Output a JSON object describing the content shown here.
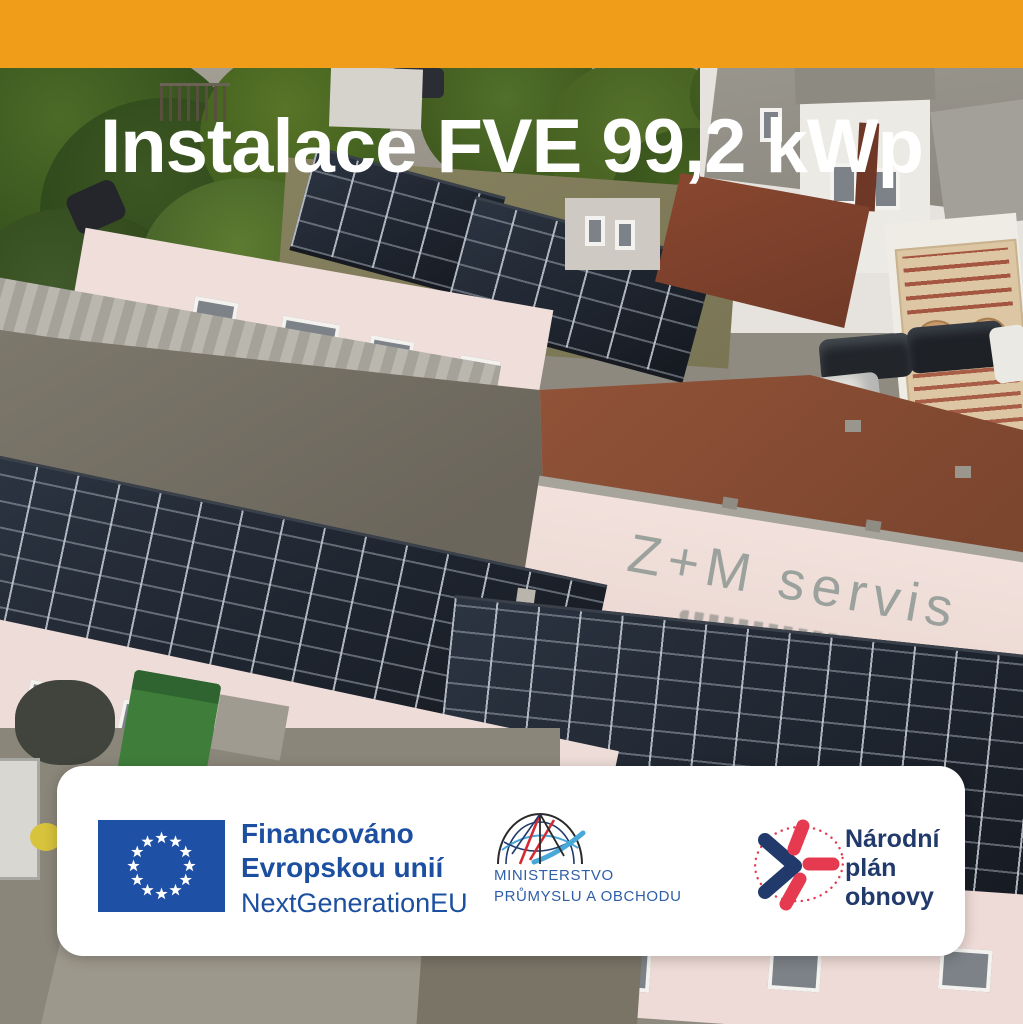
{
  "top_bar": {
    "color": "#F09D1A"
  },
  "headline": {
    "text": "Instalace FVE 99,2 kWp",
    "color": "#FFFFFF"
  },
  "photo": {
    "building_sign": {
      "text": "Z+M servis",
      "color": "#9BA19C"
    }
  },
  "footer_banner": {
    "background": "#FFFFFF",
    "eu_attribution": {
      "line1": "Financováno",
      "line2": "Evropskou unií",
      "line3": "NextGenerationEU",
      "flag_blue": "#1E50A5",
      "star_color": "#FFFFFF",
      "text_blue": "#1D4FA1"
    },
    "ministry": {
      "line1": "MINISTERSTVO",
      "line2": "PRŮMYSLU A OBCHODU",
      "text_blue": "#2E5FA7"
    },
    "npo": {
      "line1": "Národní",
      "line2": "plán",
      "line3": "obnovy",
      "navy": "#213A6B",
      "red": "#E53A4F"
    }
  }
}
